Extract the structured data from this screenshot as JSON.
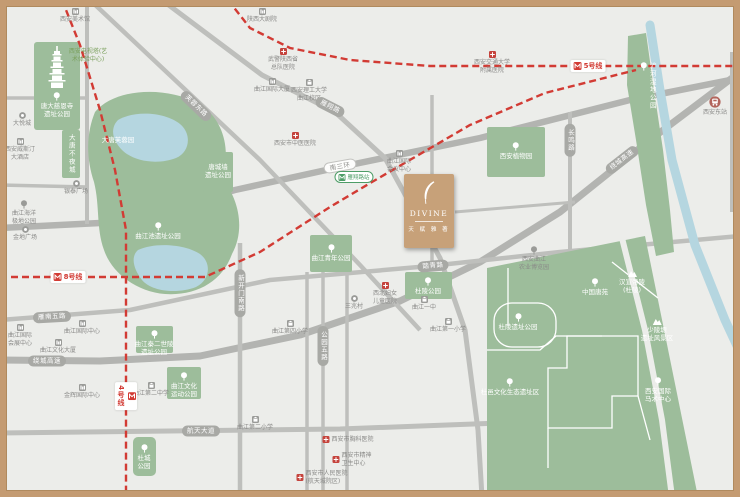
{
  "colors": {
    "bg": "#ecedea",
    "frame": "#c49b72",
    "park": "#9dbd9b",
    "water": "#b5d6e0",
    "road": "#bebfbc",
    "road_major": "#b3b4b1",
    "metro_red": "#d23b34",
    "project_gold": "#c7a179",
    "capsule": "#a8a9a5",
    "poi_text": "#8a8a88",
    "station_green": "#4e9d67"
  },
  "project": {
    "x": 404,
    "y": 174,
    "w": 50,
    "h": 74,
    "name_en": "DIVINE",
    "name_cn": "天 赋 雅 著"
  },
  "metro": {
    "station": {
      "x": 354,
      "y": 177,
      "text": "雁翔路站"
    },
    "lines": [
      {
        "label": "4号线",
        "points": [
          [
            62,
            0
          ],
          [
            80,
            45
          ],
          [
            100,
            110
          ],
          [
            115,
            170
          ],
          [
            126,
            230
          ],
          [
            126,
            497
          ]
        ],
        "label_x": 126,
        "label_y": 396,
        "vert": true
      },
      {
        "label": "5号线",
        "points": [
          [
            228,
            0
          ],
          [
            250,
            28
          ],
          [
            290,
            48
          ],
          [
            350,
            60
          ],
          [
            430,
            66
          ],
          [
            740,
            66
          ]
        ],
        "label_x": 588,
        "label_y": 66,
        "vert": false
      },
      {
        "label": "8号线",
        "points": [
          [
            0,
            277
          ],
          [
            205,
            277
          ],
          [
            260,
            252
          ],
          [
            330,
            207
          ],
          [
            372,
            182
          ],
          [
            470,
            125
          ],
          [
            545,
            93
          ],
          [
            636,
            70
          ]
        ],
        "label_x": 68,
        "label_y": 277,
        "vert": false
      }
    ]
  },
  "roads": {
    "paths": [
      {
        "points": [
          [
            0,
            228
          ],
          [
            120,
            222
          ],
          [
            235,
            190
          ],
          [
            340,
            167
          ],
          [
            480,
            138
          ],
          [
            630,
            100
          ],
          [
            740,
            78
          ]
        ],
        "w": 6.5,
        "major": true
      },
      {
        "points": [
          [
            0,
            360
          ],
          [
            100,
            361
          ],
          [
            200,
            356
          ],
          [
            300,
            335
          ],
          [
            400,
            301
          ],
          [
            480,
            262
          ],
          [
            560,
            212
          ],
          [
            650,
            140
          ],
          [
            740,
            72
          ]
        ],
        "w": 7,
        "major": true
      },
      {
        "points": [
          [
            90,
            0
          ],
          [
            260,
            160
          ],
          [
            360,
            265
          ],
          [
            420,
            330
          ]
        ],
        "w": 4.5
      },
      {
        "points": [
          [
            162,
            0
          ],
          [
            262,
            75
          ],
          [
            335,
            112
          ],
          [
            385,
            158
          ],
          [
            440,
            258
          ],
          [
            465,
            330
          ],
          [
            478,
            430
          ],
          [
            482,
            497
          ]
        ],
        "w": 5
      },
      {
        "points": [
          [
            0,
            320
          ],
          [
            130,
            310
          ],
          [
            270,
            280
          ],
          [
            430,
            266
          ],
          [
            560,
            252
          ],
          [
            740,
            236
          ]
        ],
        "w": 4.5
      },
      {
        "points": [
          [
            0,
            433
          ],
          [
            340,
            429
          ],
          [
            500,
            423
          ],
          [
            620,
            416
          ]
        ],
        "w": 5
      },
      {
        "points": [
          [
            87,
            0
          ],
          [
            87,
            224
          ]
        ],
        "w": 4
      },
      {
        "points": [
          [
            0,
            98
          ],
          [
            87,
            98
          ]
        ],
        "w": 3.5
      },
      {
        "points": [
          [
            0,
            185
          ],
          [
            87,
            187
          ]
        ],
        "w": 3.5
      },
      {
        "points": [
          [
            240,
            243
          ],
          [
            240,
            497
          ]
        ],
        "w": 4.5
      },
      {
        "points": [
          [
            307,
            272
          ],
          [
            307,
            497
          ]
        ],
        "w": 3.5
      },
      {
        "points": [
          [
            323,
            270
          ],
          [
            323,
            497
          ]
        ],
        "w": 3.5
      },
      {
        "points": [
          [
            347,
            268
          ],
          [
            347,
            497
          ]
        ],
        "w": 3.5
      },
      {
        "points": [
          [
            432,
            95
          ],
          [
            432,
            268
          ]
        ],
        "w": 3.5
      },
      {
        "points": [
          [
            570,
            112
          ],
          [
            570,
            253
          ]
        ],
        "w": 4
      },
      {
        "points": [
          [
            732,
            52
          ],
          [
            732,
            212
          ]
        ],
        "w": 4
      },
      {
        "points": [
          [
            455,
            212
          ],
          [
            575,
            202
          ]
        ],
        "w": 3
      }
    ],
    "capsules": [
      {
        "text": "南三环",
        "x": 340,
        "y": 166,
        "angle": -10,
        "style": "white"
      },
      {
        "text": "芙蓉东路",
        "x": 196,
        "y": 106,
        "angle": 44,
        "style": ""
      },
      {
        "text": "雁翔路",
        "x": 330,
        "y": 107,
        "angle": 27,
        "style": ""
      },
      {
        "text": "长鸣路",
        "x": 570,
        "y": 140,
        "angle": 90,
        "style": ""
      },
      {
        "text": "绕城高速",
        "x": 47,
        "y": 361,
        "angle": 0,
        "style": ""
      },
      {
        "text": "绕城高速",
        "x": 622,
        "y": 160,
        "angle": -38,
        "style": ""
      },
      {
        "text": "雁南五路",
        "x": 52,
        "y": 317,
        "angle": -3,
        "style": ""
      },
      {
        "text": "踏青路",
        "x": 433,
        "y": 266,
        "angle": -5,
        "style": ""
      },
      {
        "text": "航天大道",
        "x": 201,
        "y": 431,
        "angle": 0,
        "style": ""
      },
      {
        "text": "新开门南路",
        "x": 240,
        "y": 293,
        "angle": 90,
        "style": ""
      },
      {
        "text": "公园五路",
        "x": 323,
        "y": 346,
        "angle": 90,
        "style": ""
      }
    ]
  },
  "water": {
    "river": [
      [
        650,
        25
      ],
      [
        660,
        90
      ],
      [
        672,
        160
      ],
      [
        695,
        245
      ],
      [
        725,
        320
      ],
      [
        738,
        348
      ]
    ],
    "lakes": [
      "M118,120 C135,110 165,112 180,124 C192,134 190,152 176,158 C158,165 134,162 122,150 C112,140 110,128 118,120 Z",
      "M138,250 C155,242 185,244 200,254 C212,263 210,280 196,287 C178,294 152,292 142,280 C134,270 130,257 138,250 Z"
    ]
  },
  "parks": {
    "rects": [
      {
        "x": 34,
        "y": 42,
        "w": 46,
        "h": 88,
        "r": 3
      },
      {
        "x": 62,
        "y": 130,
        "w": 18,
        "h": 48,
        "r": 2
      },
      {
        "x": 203,
        "y": 152,
        "w": 30,
        "h": 40,
        "r": 2
      },
      {
        "x": 487,
        "y": 127,
        "w": 58,
        "h": 50,
        "r": 2
      },
      {
        "x": 310,
        "y": 235,
        "w": 42,
        "h": 37,
        "r": 2
      },
      {
        "x": 405,
        "y": 272,
        "w": 47,
        "h": 27,
        "r": 2
      },
      {
        "x": 136,
        "y": 326,
        "w": 37,
        "h": 27,
        "r": 2
      },
      {
        "x": 167,
        "y": 367,
        "w": 34,
        "h": 32,
        "r": 2
      },
      {
        "x": 133,
        "y": 437,
        "w": 23,
        "h": 39,
        "r": 5
      }
    ],
    "blobs": [
      "M95,112 C115,88 165,86 198,103 C222,117 232,148 222,178 C238,198 246,228 232,254 C222,282 196,296 165,294 C138,292 112,274 104,250 C96,228 100,206 94,182 C86,158 86,134 95,112 Z"
    ],
    "polys": [
      [
        [
          628,
          36
        ],
        [
          646,
          33
        ],
        [
          654,
          90
        ],
        [
          663,
          150
        ],
        [
          670,
          210
        ],
        [
          674,
          252
        ],
        [
          656,
          256
        ],
        [
          646,
          205
        ],
        [
          636,
          140
        ],
        [
          627,
          85
        ]
      ],
      [
        [
          487,
          268
        ],
        [
          645,
          236
        ],
        [
          698,
          497
        ],
        [
          487,
          497
        ]
      ]
    ],
    "whitelines": [
      "M508,268 L508,326",
      "M487,350 L540,350 L556,336 L602,336",
      "M567,336 L638,336 L638,396 L612,396 L612,428 L548,428 L548,368 L567,368 Z",
      "M612,262 L658,298",
      "M548,428 L548,468",
      "M638,396 L650,440"
    ],
    "whiterect": {
      "x": 494,
      "y": 303,
      "w": 62,
      "h": 44,
      "r": 18
    },
    "greenroad": [
      [
        622,
        238
      ],
      [
        645,
        330
      ],
      [
        662,
        420
      ],
      [
        672,
        497
      ]
    ]
  },
  "labels": {
    "green": [
      {
        "x": 57,
        "y": 92,
        "icon": "tree",
        "lines": [
          "唐大慈恩寺",
          "遗址公园"
        ]
      },
      {
        "x": 71,
        "y": 134,
        "vert": true,
        "lines": [
          "大唐不夜城"
        ]
      },
      {
        "x": 118,
        "y": 136,
        "lines": [
          "大唐芙蓉园"
        ]
      },
      {
        "x": 158,
        "y": 222,
        "icon": "tree",
        "lines": [
          "曲江池遗址公园"
        ]
      },
      {
        "x": 218,
        "y": 163,
        "lines": [
          "唐城墙",
          "遗址公园"
        ]
      },
      {
        "x": 331,
        "y": 244,
        "icon": "tree",
        "lines": [
          "曲江青年公园"
        ]
      },
      {
        "x": 428,
        "y": 277,
        "icon": "tree",
        "lines": [
          "杜陵公园"
        ]
      },
      {
        "x": 516,
        "y": 142,
        "icon": "tree",
        "lines": [
          "西安植物园"
        ]
      },
      {
        "x": 595,
        "y": 278,
        "icon": "tree",
        "lines": [
          "中国唐苑"
        ]
      },
      {
        "x": 518,
        "y": 313,
        "icon": "tree",
        "lines": [
          "杜陵遗址公园"
        ]
      },
      {
        "x": 510,
        "y": 378,
        "icon": "tree",
        "lines": [
          "杜邑文化生态遗址区"
        ]
      },
      {
        "x": 632,
        "y": 270,
        "icon": "mountain",
        "lines": [
          "汉宣帝陵",
          "(杜陵)"
        ]
      },
      {
        "x": 657,
        "y": 318,
        "icon": "mountain",
        "lines": [
          "少陵塬",
          "遗址风景区"
        ]
      },
      {
        "x": 658,
        "y": 377,
        "icon": "tree",
        "lines": [
          "西安国际",
          "马术中心"
        ]
      },
      {
        "x": 154,
        "y": 330,
        "icon": "tree",
        "lines": [
          "曲江秦二世陵",
          "遗址公园"
        ]
      },
      {
        "x": 184,
        "y": 372,
        "icon": "tree",
        "lines": [
          "曲江文化",
          "运动公园"
        ]
      },
      {
        "x": 144,
        "y": 444,
        "icon": "tree",
        "lines": [
          "杜城",
          "公园"
        ]
      },
      {
        "x": 648,
        "y": 62,
        "icon": "tree",
        "vert": true,
        "lines": [
          "浐河湿地公园"
        ]
      }
    ]
  },
  "pois": [
    {
      "x": 75,
      "y": 8,
      "icon": "building",
      "lines": [
        "西安美术馆"
      ]
    },
    {
      "x": 262,
      "y": 8,
      "icon": "building",
      "lines": [
        "陕西大剧院"
      ]
    },
    {
      "x": 88,
      "y": 48,
      "cls": "greentext",
      "lines": [
        "西安电视塔(艺",
        "术体验中心)"
      ]
    },
    {
      "x": 22,
      "y": 112,
      "icon": "commerce",
      "lines": [
        "大悦城"
      ]
    },
    {
      "x": 20,
      "y": 138,
      "icon": "building",
      "lines": [
        "西安威斯汀",
        "大酒店"
      ]
    },
    {
      "x": 76,
      "y": 180,
      "icon": "commerce",
      "lines": [
        "银泰广场"
      ]
    },
    {
      "x": 24,
      "y": 200,
      "icon": "tree",
      "lines": [
        "曲江海洋",
        "极地公园"
      ]
    },
    {
      "x": 25,
      "y": 226,
      "icon": "commerce",
      "lines": [
        "金地广场"
      ]
    },
    {
      "x": 283,
      "y": 48,
      "icon": "cross",
      "lines": [
        "武警陕西省",
        "总队医院"
      ]
    },
    {
      "x": 272,
      "y": 78,
      "icon": "building",
      "lines": [
        "曲江国际大厦"
      ]
    },
    {
      "x": 309,
      "y": 79,
      "icon": "school",
      "lines": [
        "西安理工大学",
        "曲江校区"
      ]
    },
    {
      "x": 295,
      "y": 132,
      "icon": "cross",
      "lines": [
        "西安市中医医院"
      ]
    },
    {
      "x": 399,
      "y": 150,
      "icon": "building",
      "lines": [
        "曲江国际",
        "会议中心"
      ]
    },
    {
      "x": 492,
      "y": 51,
      "icon": "cross",
      "lines": [
        "西安交通大学",
        "附属医院"
      ]
    },
    {
      "x": 385,
      "y": 282,
      "icon": "cross",
      "lines": [
        "西北妇女",
        "儿童医院"
      ]
    },
    {
      "x": 354,
      "y": 295,
      "icon": "commerce",
      "lines": [
        "三兆村"
      ]
    },
    {
      "x": 290,
      "y": 320,
      "icon": "school",
      "lines": [
        "曲江第四小学"
      ]
    },
    {
      "x": 448,
      "y": 318,
      "icon": "school",
      "lines": [
        "曲江第一小学"
      ]
    },
    {
      "x": 424,
      "y": 296,
      "icon": "school",
      "lines": [
        "曲江一中"
      ]
    },
    {
      "x": 20,
      "y": 324,
      "icon": "building",
      "lines": [
        "曲江国际",
        "会展中心"
      ]
    },
    {
      "x": 82,
      "y": 320,
      "icon": "building",
      "lines": [
        "曲江国际中心"
      ]
    },
    {
      "x": 58,
      "y": 339,
      "icon": "building",
      "lines": [
        "曲江文化大厦"
      ]
    },
    {
      "x": 82,
      "y": 384,
      "icon": "building",
      "lines": [
        "金辉国际中心"
      ]
    },
    {
      "x": 151,
      "y": 382,
      "icon": "school",
      "lines": [
        "曲江第二中学"
      ]
    },
    {
      "x": 255,
      "y": 416,
      "icon": "school",
      "lines": [
        "曲江第二小学"
      ]
    },
    {
      "x": 348,
      "y": 436,
      "icon": "cross",
      "lines": [
        "西安市胸科医院"
      ],
      "row": true
    },
    {
      "x": 352,
      "y": 452,
      "icon": "cross",
      "lines": [
        "西安市精神",
        "卫生中心"
      ],
      "row": true
    },
    {
      "x": 322,
      "y": 470,
      "icon": "cross",
      "lines": [
        "西安市人民医院",
        "(航天城院区)"
      ],
      "row": true
    },
    {
      "x": 534,
      "y": 246,
      "icon": "tree",
      "lines": [
        "西安曲江",
        "农业博览园"
      ]
    },
    {
      "x": 715,
      "y": 96,
      "icon": "train",
      "lines": [
        "西安东站"
      ]
    }
  ]
}
